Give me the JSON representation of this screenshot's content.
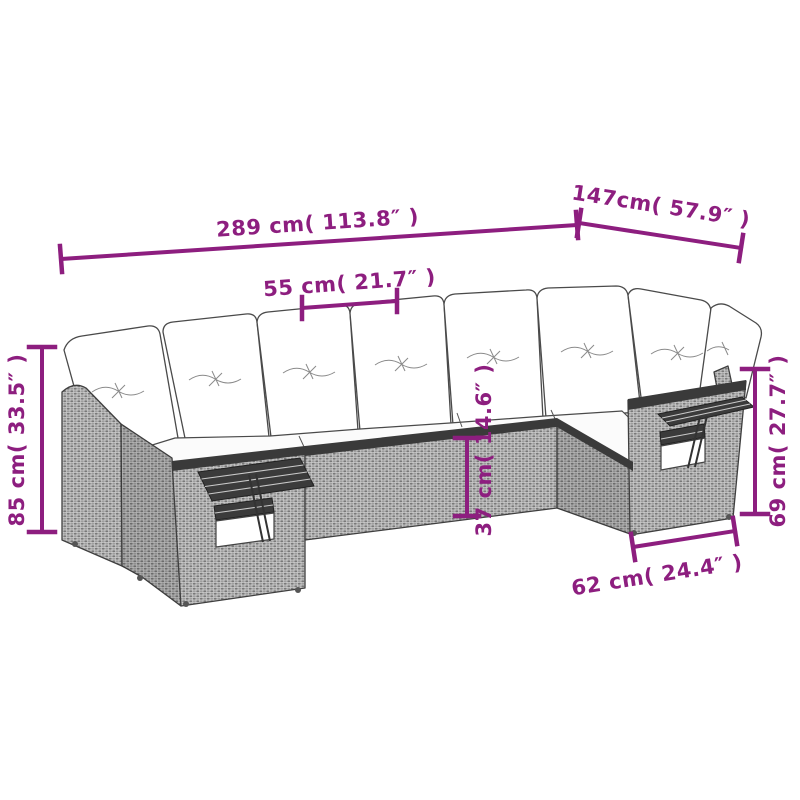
{
  "figure": {
    "description": "Gray poly-rattan U-shaped garden sofa set with white cushions and fold-out side tables, line-art product dimension diagram",
    "accent_color": "#8d1e7f",
    "wicker_color": "#9a9a9a",
    "cushion_color": "#ffffff",
    "slat_color": "#3b3b3b"
  },
  "dimensions": {
    "overall_width": "289 cm( 113.8″ )",
    "overall_depth": "147cm( 57.9″ )",
    "seat_width": "55 cm( 21.7″ )",
    "total_height": "85 cm( 33.5″ )",
    "arm_height": "69 cm( 27.7″ )",
    "seat_height": "37 cm( 14.6″ )",
    "end_section_depth": "62 cm( 24.4″ )"
  }
}
